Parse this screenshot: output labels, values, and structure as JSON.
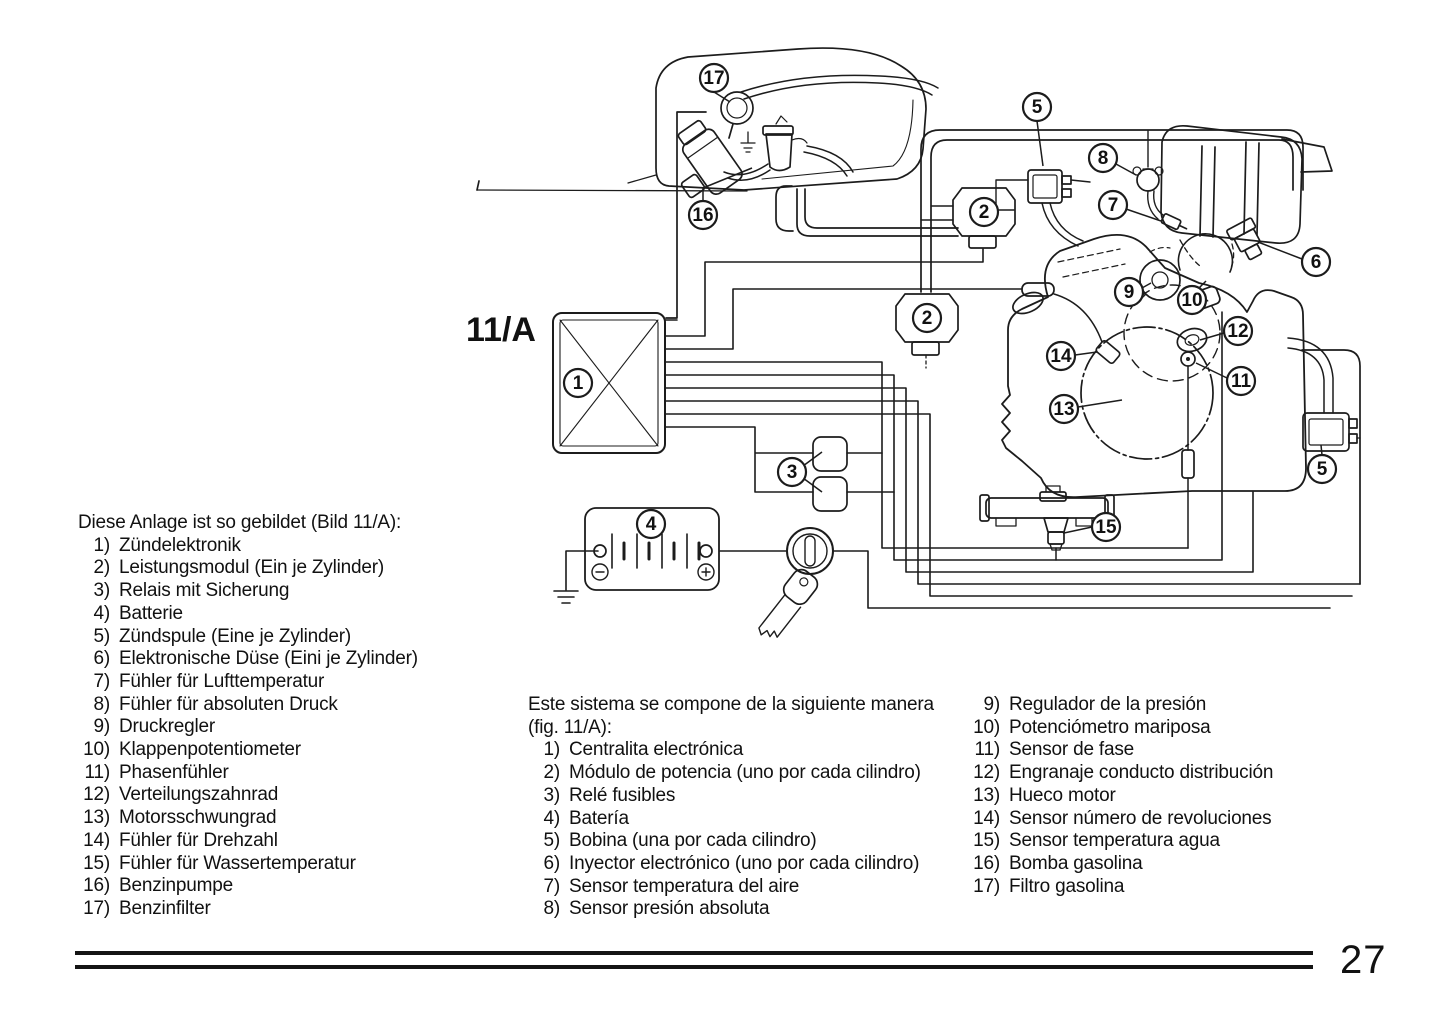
{
  "figure_label": "11/A",
  "page_number": "27",
  "diagram": {
    "callouts": [
      {
        "n": "1",
        "x": 578,
        "y": 383
      },
      {
        "n": "2",
        "x": 984,
        "y": 212
      },
      {
        "n": "2",
        "x": 927,
        "y": 318
      },
      {
        "n": "3",
        "x": 792,
        "y": 472,
        "leaders": [
          [
            803,
            466,
            822,
            452
          ],
          [
            803,
            478,
            822,
            492
          ]
        ]
      },
      {
        "n": "4",
        "x": 651,
        "y": 524
      },
      {
        "n": "5",
        "x": 1037,
        "y": 107,
        "leaders": [
          [
            1037,
            121,
            1043,
            166
          ]
        ]
      },
      {
        "n": "5",
        "x": 1322,
        "y": 469,
        "leaders": [
          [
            1322,
            455,
            1321,
            445
          ]
        ]
      },
      {
        "n": "6",
        "x": 1316,
        "y": 262,
        "leaders": [
          [
            1302,
            259,
            1258,
            242
          ]
        ]
      },
      {
        "n": "7",
        "x": 1113,
        "y": 205,
        "leaders": [
          [
            1126,
            209,
            1161,
            221
          ]
        ]
      },
      {
        "n": "8",
        "x": 1103,
        "y": 158,
        "leaders": [
          [
            1116,
            164,
            1136,
            175
          ]
        ]
      },
      {
        "n": "9",
        "x": 1129,
        "y": 292,
        "leaders": [
          [
            1142,
            288,
            1151,
            283
          ]
        ]
      },
      {
        "n": "10",
        "x": 1192,
        "y": 300,
        "leaders": [
          [
            1198,
            289,
            1206,
            281
          ]
        ]
      },
      {
        "n": "11",
        "x": 1241,
        "y": 381,
        "leaders": [
          [
            1227,
            378,
            1196,
            363
          ]
        ]
      },
      {
        "n": "12",
        "x": 1238,
        "y": 331,
        "leaders": [
          [
            1224,
            333,
            1200,
            340
          ]
        ]
      },
      {
        "n": "13",
        "x": 1064,
        "y": 409,
        "leaders": [
          [
            1078,
            407,
            1122,
            400
          ]
        ]
      },
      {
        "n": "14",
        "x": 1061,
        "y": 356,
        "leaders": [
          [
            1075,
            355,
            1097,
            352
          ]
        ]
      },
      {
        "n": "15",
        "x": 1106,
        "y": 527,
        "leaders": [
          [
            1092,
            527,
            1064,
            533
          ]
        ]
      },
      {
        "n": "16",
        "x": 703,
        "y": 215,
        "leaders": [
          [
            703,
            201,
            703,
            188
          ],
          [
            703,
            188,
            752,
            168
          ]
        ]
      },
      {
        "n": "17",
        "x": 714,
        "y": 78,
        "leaders": [
          [
            714,
            92,
            730,
            102
          ]
        ]
      }
    ]
  },
  "lists": {
    "german": {
      "header": "Diese Anlage ist so gebildet (Bild 11/A):",
      "items": [
        {
          "n": "1)",
          "t": "Zündelektronik"
        },
        {
          "n": "2)",
          "t": "Leistungsmodul (Ein je Zylinder)"
        },
        {
          "n": "3)",
          "t": "Relais mit Sicherung"
        },
        {
          "n": "4)",
          "t": "Batterie"
        },
        {
          "n": "5)",
          "t": "Zündspule (Eine je Zylinder)"
        },
        {
          "n": "6)",
          "t": "Elektronische Düse (Eini je Zylinder)"
        },
        {
          "n": "7)",
          "t": "Fühler für Lufttemperatur"
        },
        {
          "n": "8)",
          "t": "Fühler für absoluten Druck"
        },
        {
          "n": "9)",
          "t": "Druckregler"
        },
        {
          "n": "10)",
          "t": "Klappenpotentiometer"
        },
        {
          "n": "11)",
          "t": "Phasenfühler"
        },
        {
          "n": "12)",
          "t": "Verteilungszahnrad"
        },
        {
          "n": "13)",
          "t": "Motorsschwungrad"
        },
        {
          "n": "14)",
          "t": "Fühler für Drehzahl"
        },
        {
          "n": "15)",
          "t": "Fühler für Wassertemperatur"
        },
        {
          "n": "16)",
          "t": "Benzinpumpe"
        },
        {
          "n": "17)",
          "t": "Benzinfilter"
        }
      ]
    },
    "spanish": {
      "header_line1": "Este sistema se compone de la siguiente manera",
      "header_line2": "(fig. 11/A):",
      "items": [
        {
          "n": "1)",
          "t": "Centralita electrónica"
        },
        {
          "n": "2)",
          "t": "Módulo de potencia (uno por cada cilindro)"
        },
        {
          "n": "3)",
          "t": "Relé fusibles"
        },
        {
          "n": "4)",
          "t": "Batería"
        },
        {
          "n": "5)",
          "t": "Bobina (una por cada cilindro)"
        },
        {
          "n": "6)",
          "t": "Inyector electrónico (uno por cada cilindro)"
        },
        {
          "n": "7)",
          "t": "Sensor temperatura del aire"
        },
        {
          "n": "8)",
          "t": "Sensor presión absoluta"
        }
      ]
    },
    "spanish2": {
      "items": [
        {
          "n": "9)",
          "t": "Regulador de la presión"
        },
        {
          "n": "10)",
          "t": "Potenciómetro mariposa"
        },
        {
          "n": "11)",
          "t": "Sensor de fase"
        },
        {
          "n": "12)",
          "t": "Engranaje conducto distribución"
        },
        {
          "n": "13)",
          "t": "Hueco motor"
        },
        {
          "n": "14)",
          "t": "Sensor número de revoluciones"
        },
        {
          "n": "15)",
          "t": "Sensor temperatura agua"
        },
        {
          "n": "16)",
          "t": "Bomba gasolina"
        },
        {
          "n": "17)",
          "t": "Filtro gasolina"
        }
      ]
    }
  }
}
